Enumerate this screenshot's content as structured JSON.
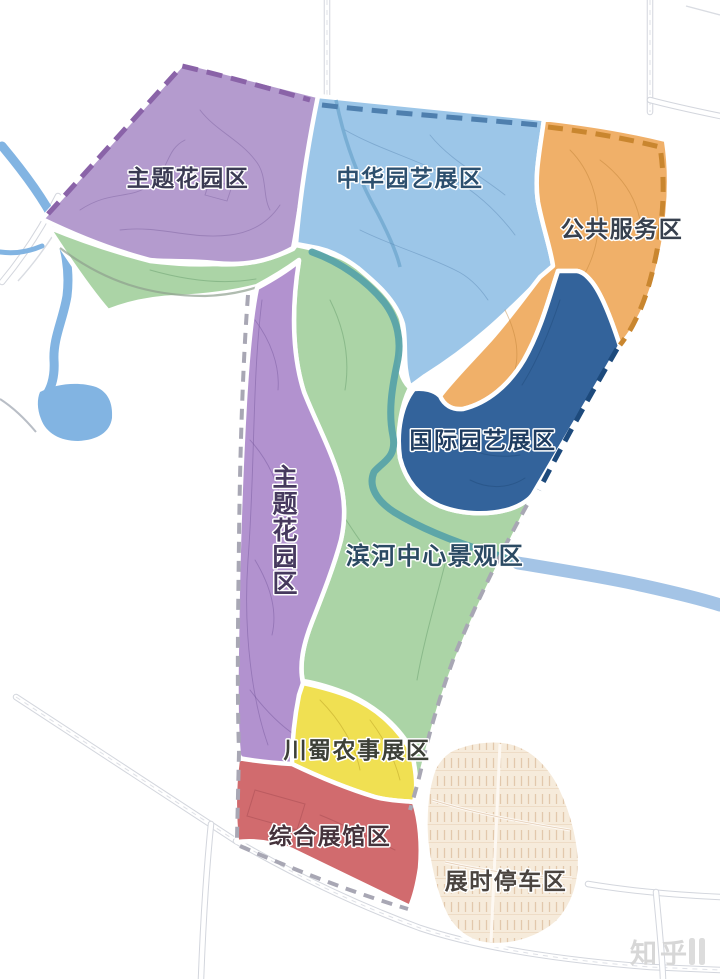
{
  "zones": [
    {
      "id": "theme-garden-north",
      "label": "主题花园区",
      "color": "#b49bce"
    },
    {
      "id": "china-horticulture-exhibition",
      "label": "中华园艺展区",
      "color": "#9cc6e8"
    },
    {
      "id": "public-service",
      "label": "公共服务区",
      "color": "#f0b069"
    },
    {
      "id": "international-horticulture-exhibition",
      "label": "国际园艺展区",
      "color": "#33639b"
    },
    {
      "id": "riverside-central-landscape",
      "label": "滨河中心景观区",
      "color": "#abd4a6"
    },
    {
      "id": "theme-garden-west",
      "label": "主题花园区",
      "color": "#b292cf"
    },
    {
      "id": "sichuan-agricultural-exhibition",
      "label": "川蜀农事展区",
      "color": "#f0e052"
    },
    {
      "id": "comprehensive-exhibition-hall",
      "label": "综合展馆区",
      "color": "#d16b6e"
    },
    {
      "id": "expo-parking",
      "label": "展时停车区",
      "color": "#f6ebdb"
    }
  ],
  "watermark": {
    "text": "知乎"
  }
}
